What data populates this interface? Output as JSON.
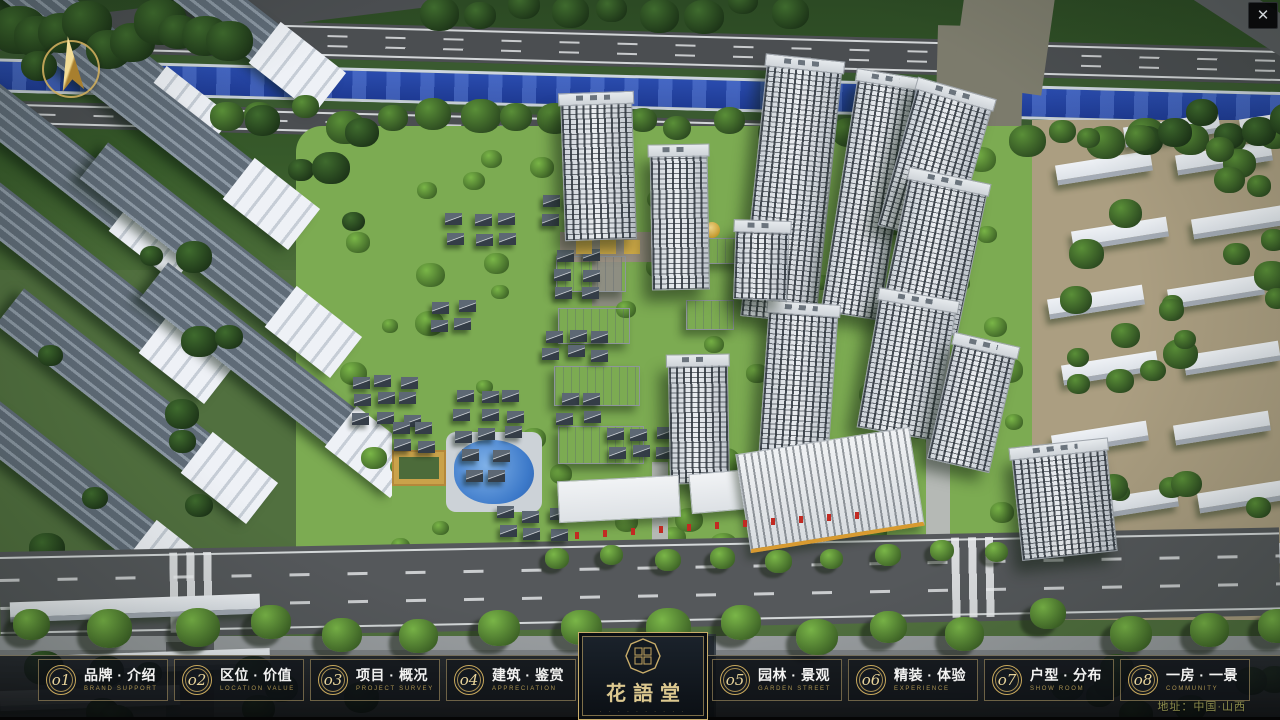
{
  "window": {
    "close_label": "✕"
  },
  "brand": {
    "name": "花語堂",
    "tagline": "· · · · · · · · · ·"
  },
  "nav": {
    "items": [
      {
        "num": "o1",
        "zh": "品牌 · 介绍",
        "en": "BRAND SUPPORT"
      },
      {
        "num": "o2",
        "zh": "区位 · 价值",
        "en": "LOCATION VALUE"
      },
      {
        "num": "o3",
        "zh": "项目 · 概况",
        "en": "PROJECT SURVEY"
      },
      {
        "num": "o4",
        "zh": "建筑 · 鉴赏",
        "en": "APPRECIATION"
      },
      {
        "num": "o5",
        "zh": "园林 · 景观",
        "en": "GARDEN STREET"
      },
      {
        "num": "o6",
        "zh": "精装 · 体验",
        "en": "EXPERIENCE"
      },
      {
        "num": "o7",
        "zh": "户型 · 分布",
        "en": "SHOW ROOM"
      },
      {
        "num": "o8",
        "zh": "一房 · 一景",
        "en": "COMMUNITY"
      }
    ]
  },
  "footer": {
    "address": "地址：中国·山西"
  },
  "scene": {
    "description": "aerial 3D masterplan rendering of residential community",
    "colors": {
      "river_blue": "#2a4cae",
      "lawn_green": "#7cab52",
      "context_green": "#27421f",
      "road_gray": "#55585b",
      "plaza_tan": "#ab9e81",
      "tower_facade": "#e3e7ea",
      "accent_gold": "#c9a95c",
      "pond_blue": "#3c79c9",
      "flag_red": "#c22a22"
    }
  }
}
